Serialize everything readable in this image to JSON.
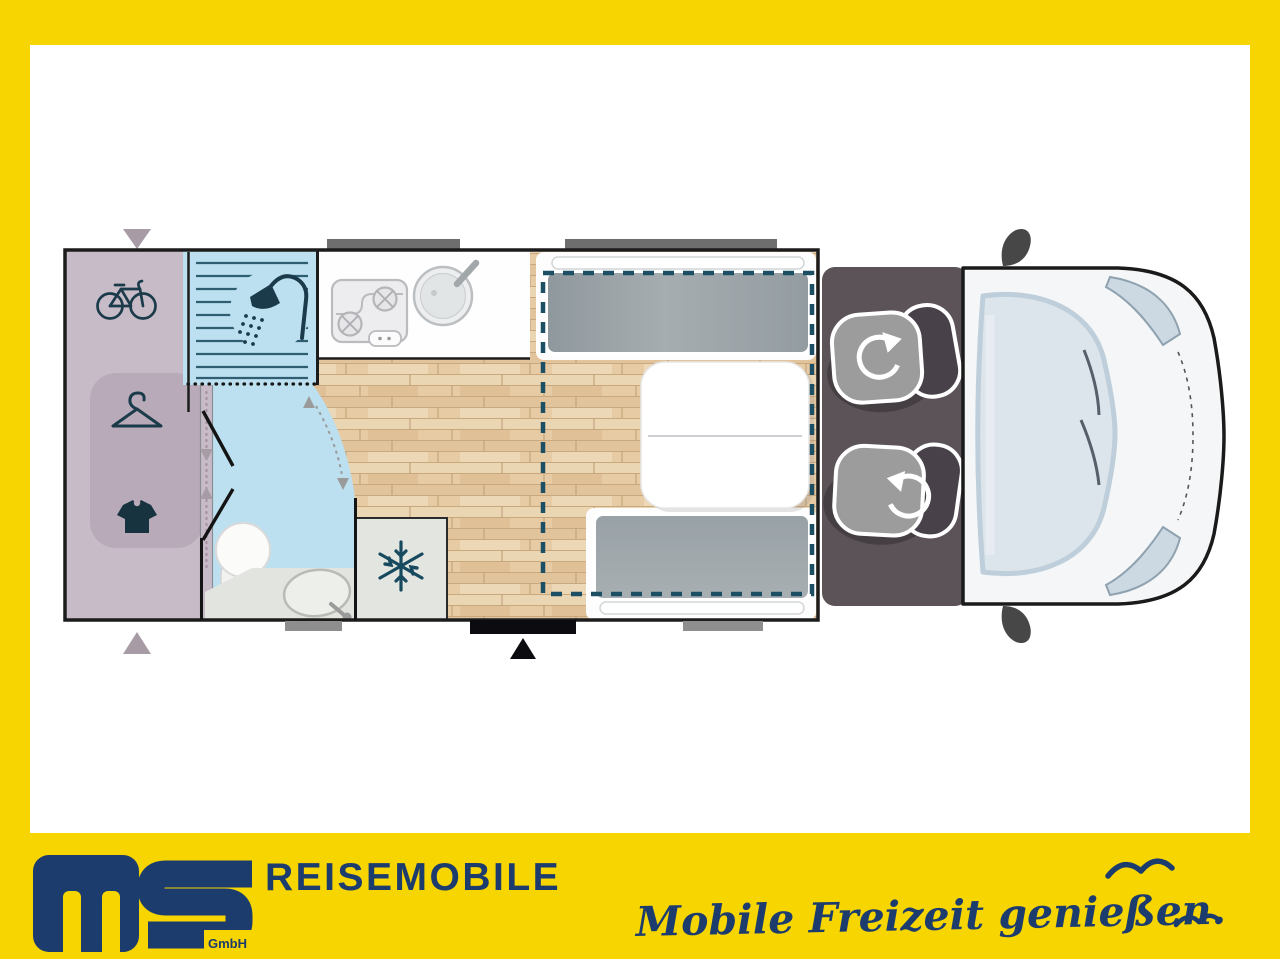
{
  "branding": {
    "logo_text": "MS",
    "logo_subtext": "GmbH",
    "company": "REISEMOBILE",
    "slogan": "Mobile Freizeit genießen.",
    "colors": {
      "band_yellow": "#F6D500",
      "navy": "#1D3C6E"
    }
  },
  "floorplan": {
    "type": "motorhome-top-view-layout",
    "zones": [
      "rear-garage-with-bike-storage",
      "wardrobe",
      "bathroom-with-shower-toilet-sink",
      "kitchen-with-stove-and-sink",
      "refrigerator",
      "dinette-with-two-benches-and-table",
      "drop-down-bed-outline",
      "cab-with-two-swivel-seats",
      "vehicle-front"
    ],
    "icons": [
      "bicycle-icon",
      "hanger-icon",
      "shirt-icon",
      "shower-icon",
      "stove-icon",
      "sink-icon",
      "snowflake-icon",
      "rotation-arrow-icon",
      "entry-arrow-icon",
      "seagull-icon"
    ],
    "accent_colors": {
      "garage_lavender": "#C8BBC8",
      "bath_blue": "#BCE0EF",
      "wood_floor": "#E6CBA5",
      "cab_gray": "#5C5359",
      "dashed_bed_line": "#1C4F63"
    }
  }
}
